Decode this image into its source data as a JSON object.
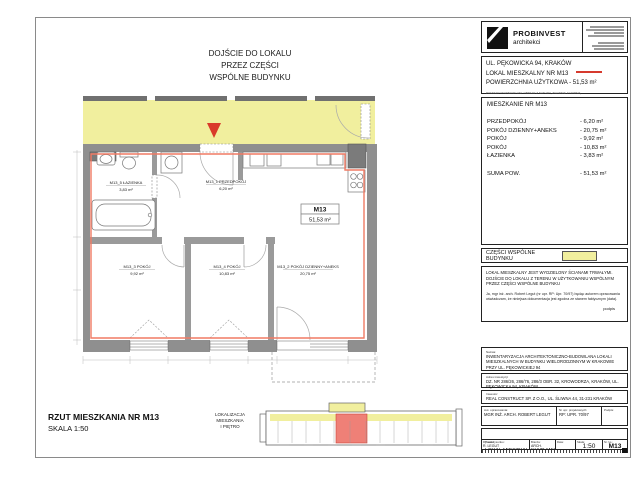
{
  "plan": {
    "corridor_note": [
      "DOJŚCIE DO LOKALU",
      "PRZEZ CZĘŚCI",
      "WSPÓLNE BUDYNKU"
    ],
    "unit_tag": {
      "number": "M13",
      "area": "51,53 m²"
    },
    "rooms": [
      {
        "label": "M13_1  PRZEDPOKÓJ",
        "area": "6,20 m²"
      },
      {
        "label": "M13_2  POKÓJ DZIENNY+ANEKS",
        "area": "20,75 m²"
      },
      {
        "label": "M13_3  POKÓJ",
        "area": "9,92 m²"
      },
      {
        "label": "M13_4  POKÓJ",
        "area": "10,83 m²"
      },
      {
        "label": "M13_5  ŁAZIENKA",
        "area": "3,83 m²"
      }
    ]
  },
  "legend": {
    "title": "RZUT MIESZKANIA NR M13",
    "scale": "SKALA 1:50"
  },
  "locator": {
    "lines": [
      "LOKALIZACJA",
      "MIESZKANIA",
      "I PIĘTRO"
    ]
  },
  "colors": {
    "corridor_yellow": "#f1ef9e",
    "unit_red_fill": "#ef8077",
    "boundary_red": "#f07a64",
    "marker_red": "#d93a2a",
    "wall_gray": "#8f8f8f"
  },
  "titleblock": {
    "brand": {
      "name": "PROBINVEST",
      "sub": "architekci"
    },
    "project": {
      "address": "UL. PĘKOWICKA 94, KRAKÓW",
      "unit": "LOKAL MIESZKALNY NR M13",
      "area": "POWIERZCHNIA UŻYTKOWA - 51,53 m²",
      "fineprint": "POMIARY POWIERZCHNI: OBMIAR Z NATURY, ZGODNIE Z NORMĄ"
    },
    "program": {
      "header": "MIESZKANIE NR M13",
      "rows": [
        {
          "name": "PRZEDPOKÓJ",
          "area": "- 6,20 m²"
        },
        {
          "name": "POKÓJ DZIENNY+ANEKS",
          "area": "- 20,75 m²"
        },
        {
          "name": "POKÓJ",
          "area": "- 9,92 m²"
        },
        {
          "name": "POKÓJ",
          "area": "- 10,83 m²"
        },
        {
          "name": "ŁAZIENKA",
          "area": "- 3,83 m²"
        }
      ],
      "sum_label": "SUMA POW.",
      "sum_area": "- 51,53 m²"
    },
    "common": {
      "header": "CZĘŚCI WSPÓLNE BUDYNKU",
      "statement": "LOKAL MIESZKALNY JEST WYDZIELONY ŚCIANAMI TRWAŁYMI. DOJŚCIE DO LOKALU Z TERENU W UŻYTKOWANIU WSPÓLNYM PRZEZ CZĘŚCI WSPÓLNE BUDYNKU",
      "declaration": "Ja, mgr inż. arch. Robert Legut (nr upr. RP: Upr. 70/97) będąc autorem opracowania oświadczam, że niniejsza dokumentacja jest zgodna ze stanem faktycznym (data).",
      "signature": "podpis"
    },
    "meta": {
      "name_label": "Nazwa:",
      "name": "INWENTARYZACJA ARCHITEKTONICZNO-BUDOWLANA LOKALI MIESZKALNYCH W BUDYNKU WIELORODZINNYM W KRAKOWIE PRZY UL. PĘKOWICKIEJ 94",
      "address_label": "Adres inwestycji:",
      "address": "DZ. NR 286/26, 286/76, 286/3 OBR. 32, KROWODRZA, KRAKÓW, UL. PĘKOWICKA 94, KRAKÓW",
      "investor_label": "Inwestor:",
      "investor": "REAL CONSTRUCT SP. Z O.O., UL. ŚLIWNA 44, 31-231 KRAKÓW",
      "author_label": "Aut. opracowania:",
      "author": "mgr inż. arch. Robert Legut",
      "license_label": "Nr upr. projektowych:",
      "license": "RP: Upr. 70/97",
      "signature_label": "Podpis:",
      "drawing_label": "Treść rysunku:",
      "drawing": "LOKAL MIESZKALNY NR M13",
      "fields": [
        {
          "label": "Rysował:",
          "value": "R. LEGUT"
        },
        {
          "label": "Branża:",
          "value": "ARCH."
        },
        {
          "label": "Data:",
          "value": ""
        },
        {
          "label": "Skala:",
          "value": "1:50"
        },
        {
          "label": "Nr rys.:",
          "value": "M13"
        }
      ]
    }
  }
}
